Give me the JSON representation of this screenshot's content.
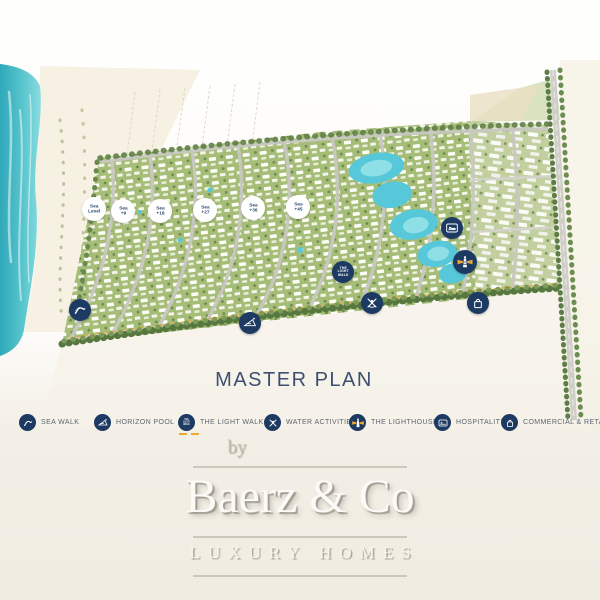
{
  "title": "MASTER PLAN",
  "map": {
    "elevation_badges": [
      {
        "line1": "Sea",
        "line2": "Level"
      },
      {
        "line1": "Sea",
        "line2": "+9"
      },
      {
        "line1": "Sea",
        "line2": "+18"
      },
      {
        "line1": "Sea",
        "line2": "+27"
      },
      {
        "line1": "Sea",
        "line2": "+36"
      },
      {
        "line1": "Sea",
        "line2": "+45"
      }
    ],
    "light_walk_badge": {
      "line1": "THE",
      "line2": "LIGHT",
      "line3": "WALK"
    }
  },
  "legend": {
    "items": [
      {
        "icon": "sea-walk-icon",
        "label": "SEA WALK"
      },
      {
        "icon": "horizon-pool-icon",
        "label": "HORIZON POOL"
      },
      {
        "icon": "light-walk-icon",
        "label": "THE LIGHT WALK"
      },
      {
        "icon": "water-activities-icon",
        "label": "WATER ACTIVITIES"
      },
      {
        "icon": "lighthouse-icon",
        "label": "THE LIGHTHOUSE"
      },
      {
        "icon": "hospitality-icon",
        "label": "HOSPITALITY"
      },
      {
        "icon": "commercial-retail-icon",
        "label": "COMMERCIAL & RETAIL"
      }
    ]
  },
  "logo": {
    "prefix": "by",
    "name": "Baerz & Co",
    "tagline": "LUXURY HOMES"
  },
  "colors": {
    "navy": "#1d3a63",
    "sea": "#45bcc8",
    "lagoon": "#56c8da",
    "accent_yellow": "#e9aa3a",
    "title_navy": "#3e4f6f"
  }
}
